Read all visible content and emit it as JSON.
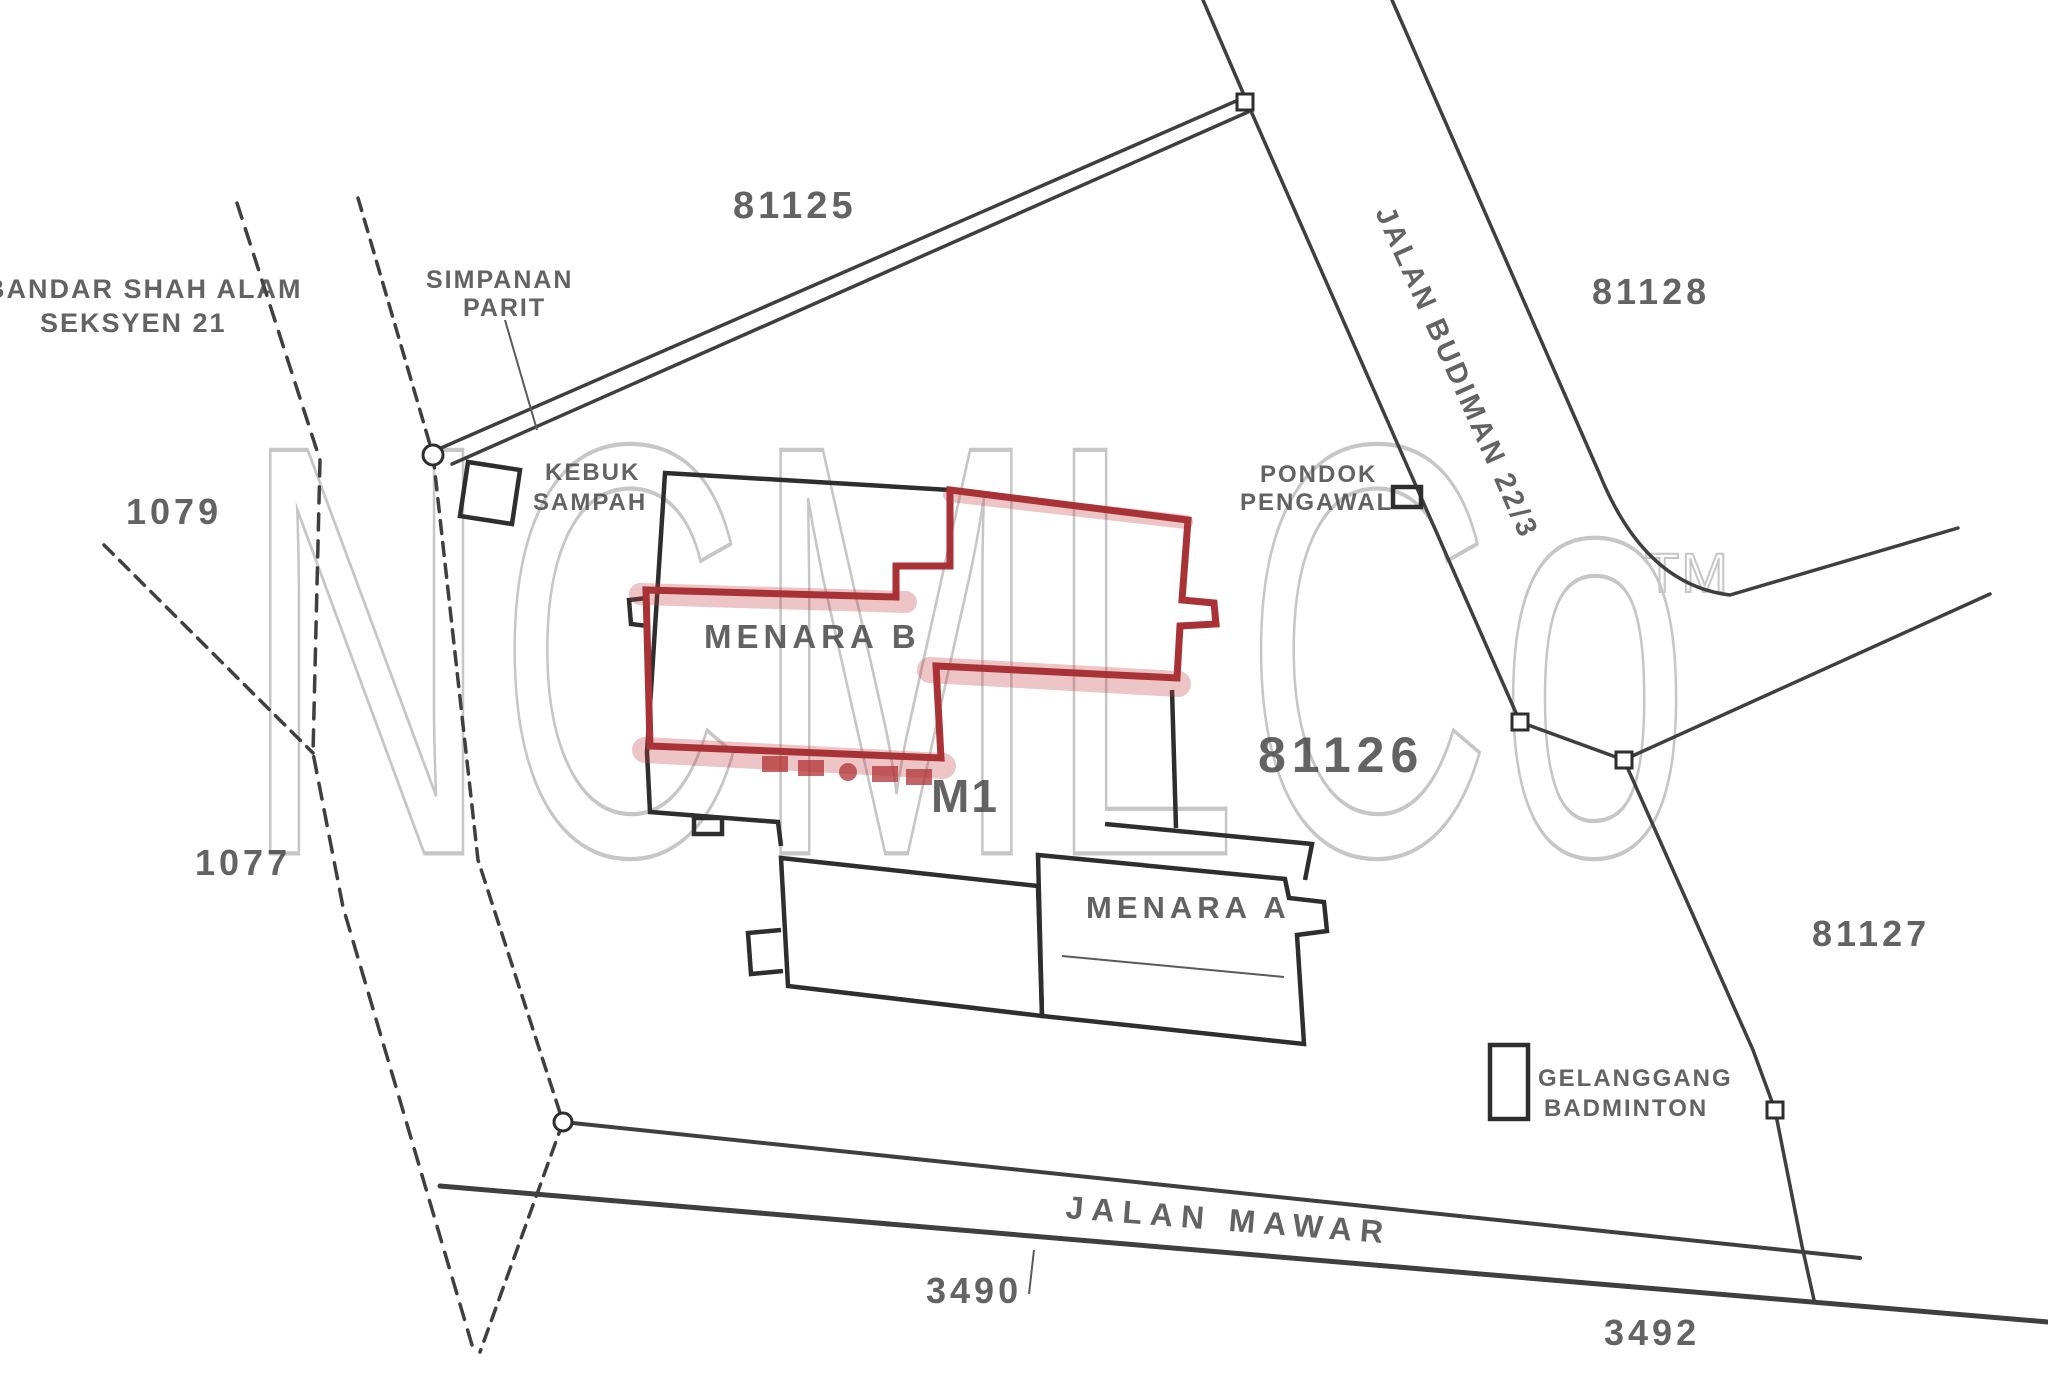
{
  "document": {
    "type": "scanned cadastral site plan",
    "highlighted_building": "MENARA B"
  },
  "colors": {
    "ink": "#3f3f3f",
    "label": "#4a4a4a",
    "highlight_red": "#a93236",
    "highlight_pink": "rgba(196,64,66,0.30)",
    "watermark_gray": "#c6c6c6",
    "background": "#ffffff"
  },
  "labels": {
    "area_line1": "BANDAR SHAH ALAM",
    "area_line2": "SEKSYEN 21",
    "lot_81125": "81125",
    "simpanan_line1": "SIMPANAN",
    "simpanan_line2": "PARIT",
    "kebuk_line1": "KEBUK",
    "kebuk_line2": "SAMPAH",
    "lot_1079": "1079",
    "lot_1077": "1077",
    "menara_b": "MENARA B",
    "pondok_line1": "PONDOK",
    "pondok_line2": "PENGAWAL",
    "jalan_budiman": "JALAN BUDIMAN 22/3",
    "lot_81128": "81128",
    "m1": "M1",
    "lot_81126": "81126",
    "menara_a": "MENARA A",
    "lot_81127": "81127",
    "gelanggang_line1": "GELANGGANG",
    "gelanggang_line2": "BADMINTON",
    "jalan_mawar": "JALAN MAWAR",
    "lot_3490": "3490",
    "lot_3492": "3492",
    "watermark": "NCMLCo",
    "watermark_tm": "TM"
  }
}
